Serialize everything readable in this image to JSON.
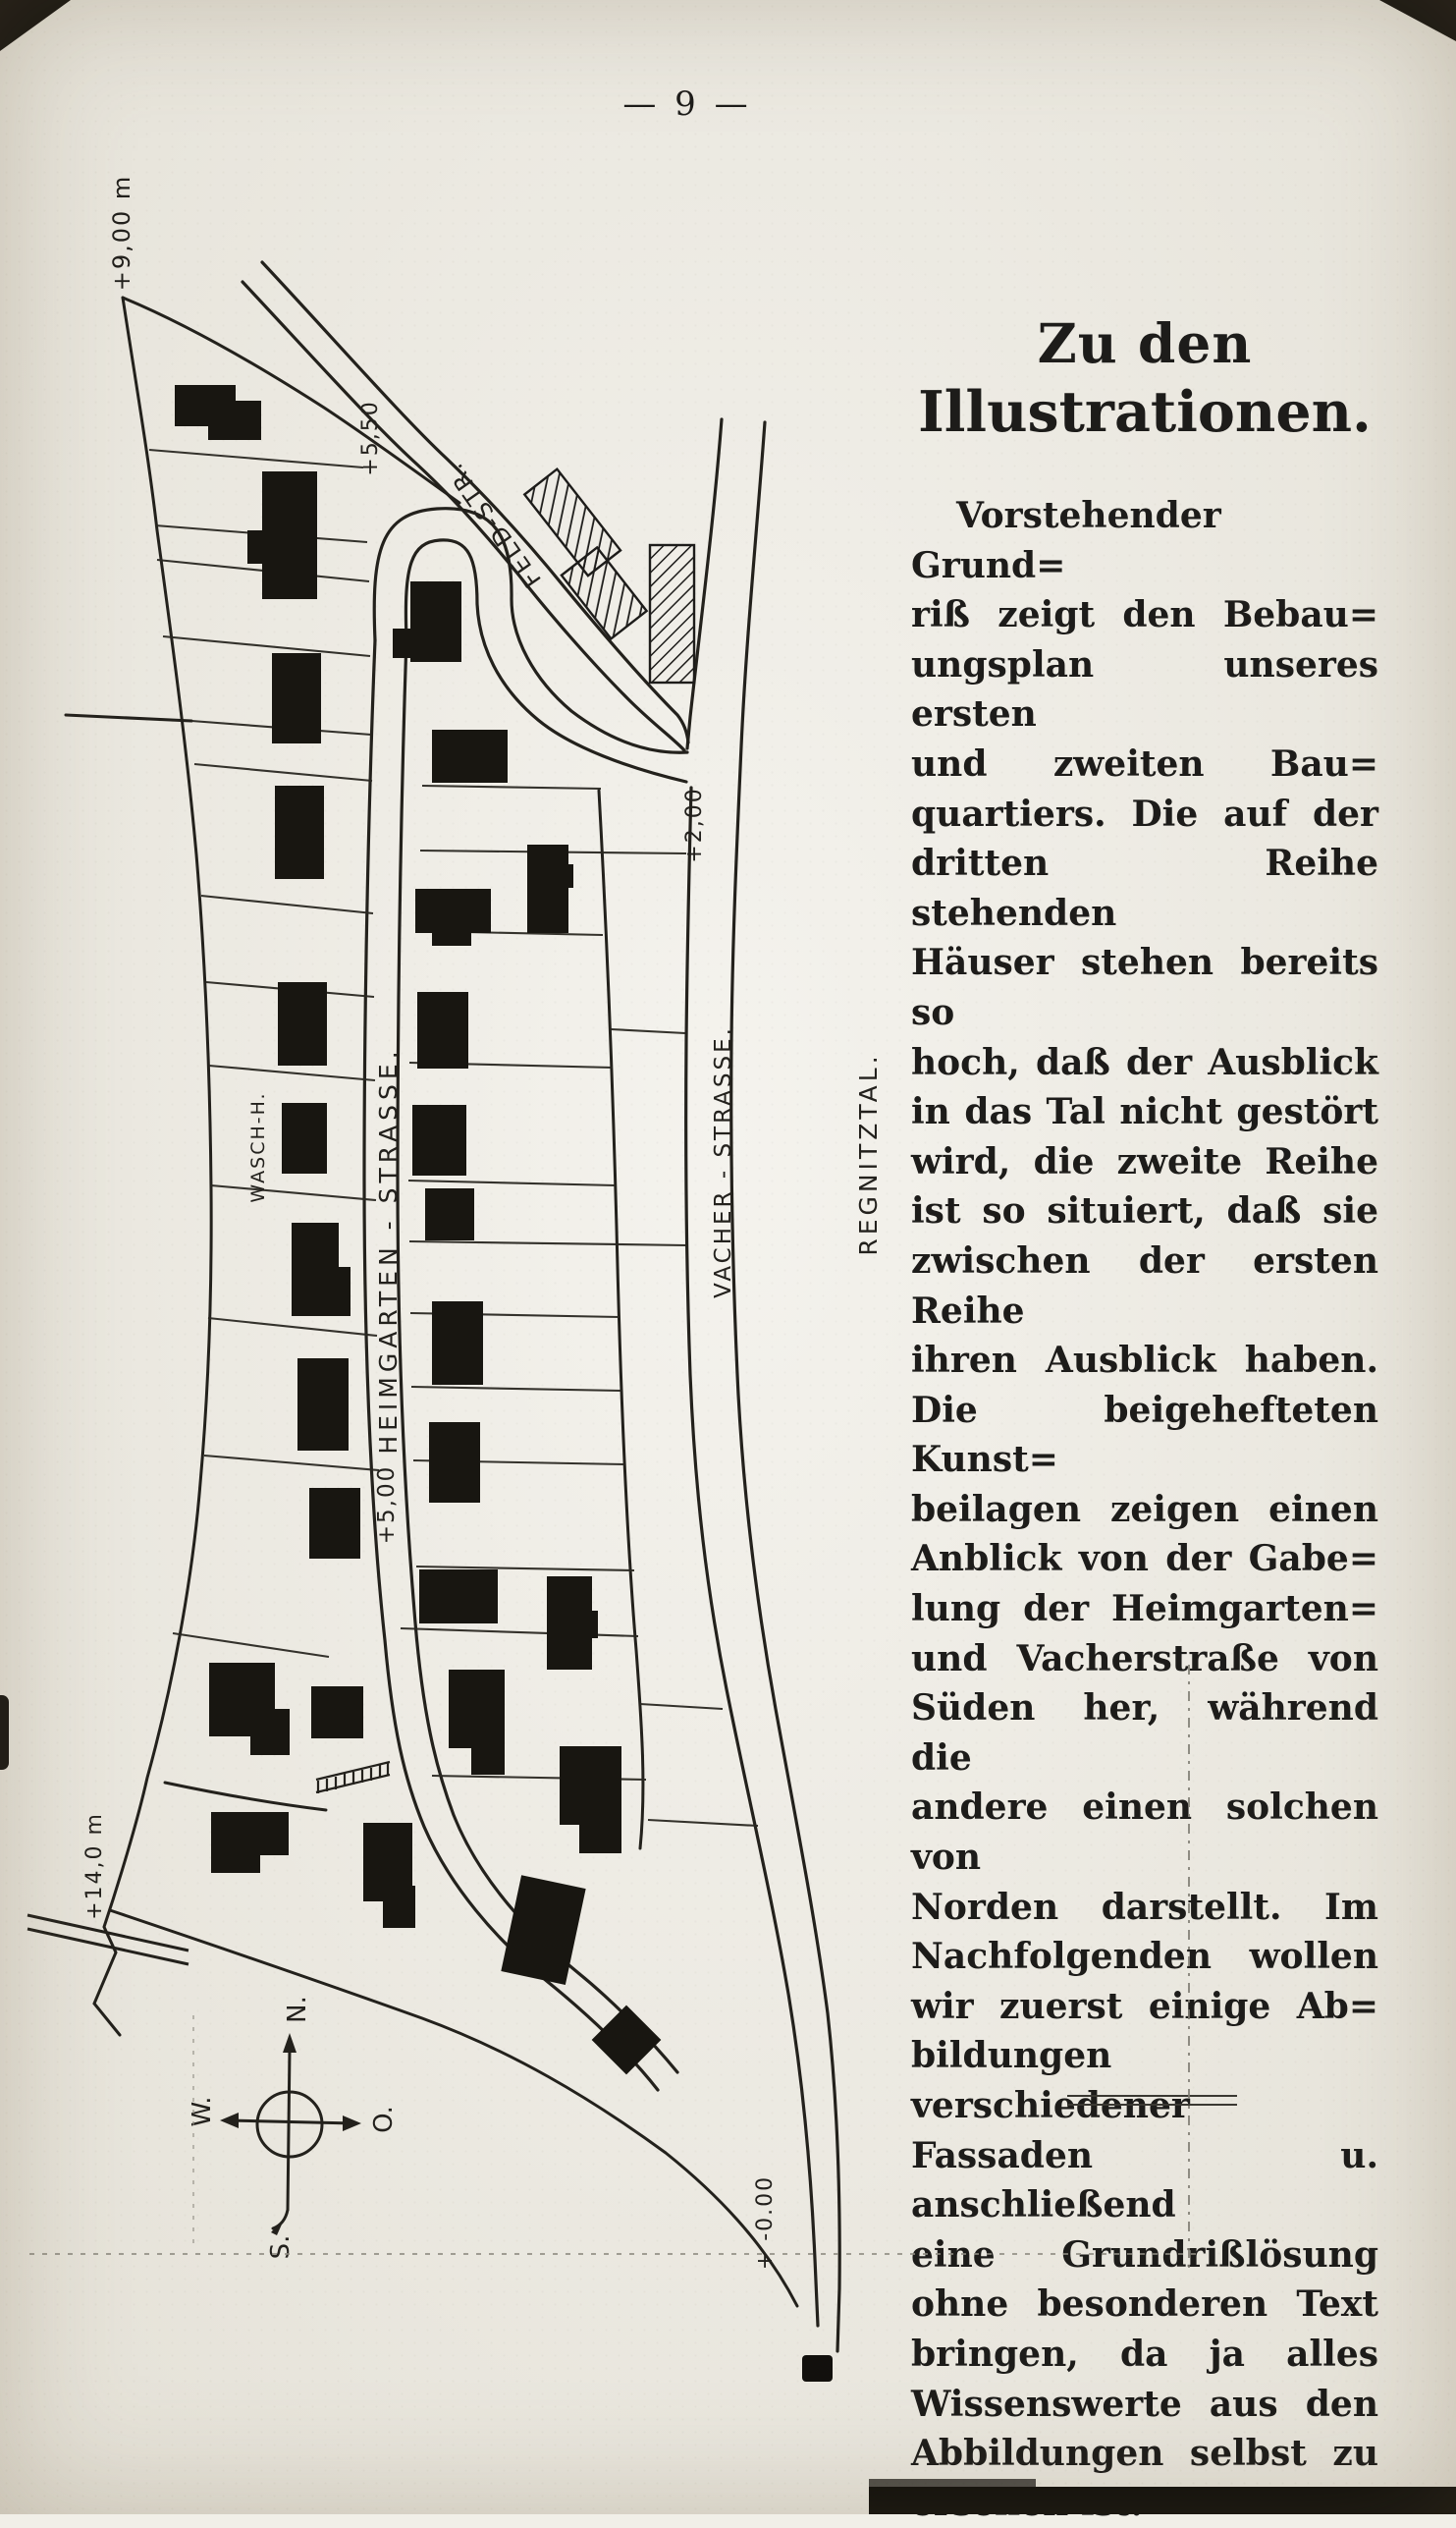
{
  "page": {
    "number": "— 9 —",
    "paper_color": "#f1efe8",
    "ink_color": "#1d1c1a"
  },
  "article": {
    "title": [
      "Zu den",
      "Illustrationen."
    ],
    "lines": [
      "Vorstehender Grund=",
      "riß zeigt den Bebau=",
      "ungsplan unseres ersten",
      "und zweiten Bau=",
      "quartiers. Die auf der",
      "dritten Reihe stehenden",
      "Häuser stehen bereits so",
      "hoch, daß der Ausblick",
      "in das Tal nicht gestört",
      "wird, die zweite Reihe",
      "ist so situiert, daß sie",
      "zwischen der ersten Reihe",
      "ihren Ausblick haben.",
      "Die beigehefteten Kunst=",
      "beilagen zeigen einen",
      "Anblick von der Gabe=",
      "lung der Heimgarten=",
      "und Vacherstraße von",
      "Süden her, während die",
      "andere einen solchen von",
      "Norden darstellt. Im",
      "Nachfolgenden wollen",
      "wir zuerst einige Ab=",
      "bildungen verschiedener",
      "Fassaden u. anschließend",
      "eine Grundrißlösung",
      "ohne besonderen Text",
      "bringen, da ja alles",
      "Wissenswerte aus den",
      "Abbildungen selbst zu",
      "ersehen ist."
    ]
  },
  "map": {
    "streets": {
      "heimgarten": "HEIMGARTEN - STRASSE.",
      "vacher": "VACHER - STRASSE.",
      "feld": "FELD-STR.",
      "wasch_house": "WASCH-H.",
      "valley": "REGNITZTAL."
    },
    "elevations": {
      "top_left": "+9,00 m",
      "feld_top": "+5,50",
      "heimgarten": "+5,00",
      "vacher_top": "+2,00",
      "bottom_left": "+14,0 m",
      "vacher_bottom": "+ -0.00"
    },
    "compass": {
      "n": "N.",
      "e": "O.",
      "s": "S.",
      "w": "W."
    }
  }
}
